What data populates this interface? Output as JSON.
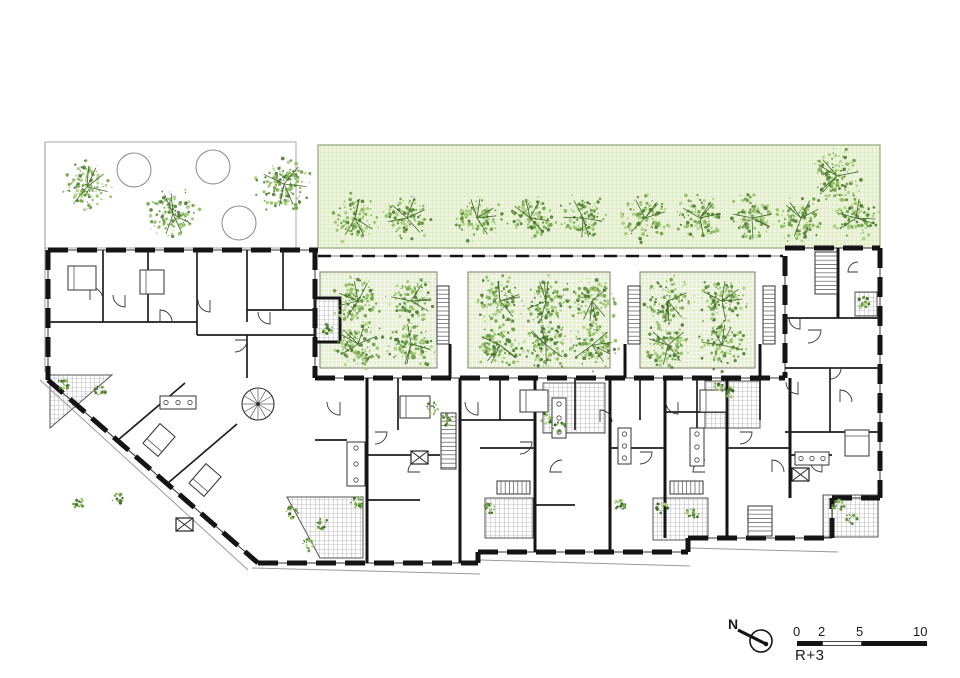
{
  "meta": {
    "level_label": "R+3"
  },
  "compass": {
    "label": "N"
  },
  "scale_bar": {
    "x": 797,
    "y": 641,
    "height": 5,
    "tick_labels": [
      "0",
      "2",
      "5",
      "10"
    ],
    "tick_offsets": [
      -4,
      21,
      59,
      116
    ],
    "segments": [
      {
        "w": 25,
        "filled": true
      },
      {
        "w": 40,
        "filled": false
      },
      {
        "w": 65,
        "filled": true
      }
    ]
  },
  "colors": {
    "wall": "#141414",
    "partition": "#1e1e1e",
    "thin": "#444444",
    "boundary": "#999999",
    "band_bg": "#edf4dd",
    "band_grid": "#d2e3b4",
    "band_border": "#93a878",
    "court_bg": "#e6f0d0",
    "court_grid": "#ffffff",
    "court_border": "#8a8a7a",
    "terrace_line": "#8d8d8d",
    "terrace_border": "#555555",
    "tree_dots": [
      "#4e7c32",
      "#6f9d48",
      "#8fbc63",
      "#a8cd80"
    ],
    "twig": "#44682c",
    "shrub_dark": "#3f662a"
  },
  "plan": {
    "garden": {
      "rect": [
        45,
        142,
        251,
        106
      ],
      "circles": [
        [
          134,
          170,
          17
        ],
        [
          213,
          167,
          17
        ],
        [
          239,
          223,
          17
        ]
      ],
      "trees": [
        [
          87,
          187,
          28
        ],
        [
          173,
          214,
          28
        ],
        [
          284,
          184,
          30
        ]
      ]
    },
    "band": {
      "rect": [
        318,
        145,
        562,
        103
      ],
      "row_y": 218,
      "row_r": 26,
      "row_x": [
        355,
        407,
        477,
        530,
        583,
        645,
        700,
        752,
        801,
        856
      ],
      "extra": [
        837,
        176,
        29
      ]
    },
    "courtyards": {
      "tree_r": 27,
      "items": [
        {
          "rect": [
            320,
            272,
            117,
            96
          ],
          "trees": [
            [
              358,
              301
            ],
            [
              411,
              301
            ],
            [
              358,
              344
            ],
            [
              411,
              344
            ]
          ]
        },
        {
          "rect": [
            468,
            272,
            142,
            96
          ],
          "trees": [
            [
              500,
              301
            ],
            [
              546,
              301
            ],
            [
              592,
              301
            ],
            [
              500,
              345
            ],
            [
              546,
              345
            ],
            [
              592,
              345
            ]
          ]
        },
        {
          "rect": [
            640,
            272,
            115,
            96
          ],
          "trees": [
            [
              668,
              301
            ],
            [
              722,
              301
            ],
            [
              668,
              345
            ],
            [
              722,
              345
            ]
          ]
        }
      ]
    },
    "facades": [
      [
        48,
        250,
        318,
        250
      ],
      [
        48,
        250,
        48,
        380
      ],
      [
        48,
        380,
        258,
        563
      ],
      [
        315,
        250,
        315,
        378
      ],
      [
        315,
        378,
        785,
        378
      ],
      [
        258,
        563,
        478,
        563
      ],
      [
        478,
        552,
        688,
        552
      ],
      [
        688,
        538,
        832,
        538
      ],
      [
        478,
        563,
        478,
        552
      ],
      [
        688,
        552,
        688,
        538
      ],
      [
        832,
        538,
        832,
        498
      ],
      [
        785,
        248,
        880,
        248
      ],
      [
        880,
        248,
        880,
        498
      ],
      [
        832,
        498,
        880,
        498
      ],
      [
        785,
        256,
        785,
        378
      ]
    ],
    "wall2": [
      [
        318,
        256,
        783,
        256
      ]
    ],
    "party": [
      [
        367,
        378,
        367,
        563
      ],
      [
        460,
        378,
        460,
        563
      ],
      [
        535,
        378,
        535,
        552
      ],
      [
        610,
        378,
        610,
        552
      ],
      [
        665,
        378,
        665,
        538
      ],
      [
        727,
        378,
        727,
        538
      ],
      [
        790,
        378,
        790,
        498
      ],
      [
        450,
        344,
        450,
        378
      ],
      [
        625,
        344,
        625,
        378
      ],
      [
        760,
        344,
        760,
        378
      ],
      [
        838,
        248,
        838,
        318
      ]
    ],
    "partitions": [
      [
        103,
        250,
        103,
        322
      ],
      [
        148,
        250,
        148,
        322
      ],
      [
        197,
        250,
        197,
        335
      ],
      [
        247,
        250,
        247,
        322
      ],
      [
        283,
        250,
        283,
        310
      ],
      [
        48,
        322,
        197,
        322
      ],
      [
        197,
        335,
        315,
        335
      ],
      [
        247,
        310,
        315,
        310
      ],
      [
        247,
        335,
        247,
        378
      ],
      [
        118,
        440,
        185,
        383
      ],
      [
        168,
        483,
        237,
        424
      ],
      [
        368,
        455,
        440,
        455
      ],
      [
        480,
        448,
        535,
        448
      ],
      [
        610,
        448,
        665,
        448
      ],
      [
        727,
        448,
        790,
        448
      ],
      [
        460,
        420,
        535,
        420
      ],
      [
        665,
        412,
        727,
        412
      ],
      [
        790,
        455,
        832,
        455
      ],
      [
        785,
        318,
        880,
        318
      ],
      [
        785,
        368,
        880,
        368
      ],
      [
        785,
        432,
        880,
        432
      ],
      [
        830,
        368,
        830,
        432
      ],
      [
        398,
        378,
        398,
        430
      ],
      [
        500,
        378,
        500,
        420
      ],
      [
        575,
        378,
        575,
        430
      ],
      [
        640,
        378,
        640,
        420
      ],
      [
        697,
        378,
        697,
        430
      ],
      [
        760,
        378,
        760,
        420
      ],
      [
        315,
        440,
        347,
        440
      ],
      [
        367,
        500,
        420,
        500
      ],
      [
        535,
        505,
        575,
        505
      ]
    ],
    "terraces": [
      {
        "poly": [
          [
            50,
            375
          ],
          [
            112,
            375
          ],
          [
            50,
            428
          ]
        ]
      },
      {
        "poly": [
          [
            287,
            497
          ],
          [
            363,
            497
          ],
          [
            363,
            558
          ],
          [
            320,
            558
          ]
        ]
      },
      {
        "poly": [
          [
            543,
            383
          ],
          [
            605,
            383
          ],
          [
            605,
            433
          ],
          [
            543,
            433
          ]
        ]
      },
      {
        "poly": [
          [
            705,
            381
          ],
          [
            760,
            381
          ],
          [
            760,
            428
          ],
          [
            705,
            428
          ]
        ]
      },
      {
        "poly": [
          [
            485,
            498
          ],
          [
            533,
            498
          ],
          [
            533,
            538
          ],
          [
            485,
            538
          ]
        ]
      },
      {
        "poly": [
          [
            653,
            498
          ],
          [
            708,
            498
          ],
          [
            708,
            540
          ],
          [
            653,
            540
          ]
        ]
      },
      {
        "poly": [
          [
            823,
            495
          ],
          [
            878,
            495
          ],
          [
            878,
            537
          ],
          [
            823,
            537
          ]
        ]
      },
      {
        "poly": [
          [
            315,
            298
          ],
          [
            340,
            298
          ],
          [
            340,
            342
          ],
          [
            315,
            342
          ]
        ],
        "thick": true
      },
      {
        "poly": [
          [
            855,
            292
          ],
          [
            877,
            292
          ],
          [
            877,
            316
          ],
          [
            855,
            316
          ]
        ]
      }
    ],
    "stairs": [
      [
        441,
        413,
        15,
        56,
        "v"
      ],
      [
        815,
        252,
        22,
        42,
        "v"
      ],
      [
        497,
        481,
        33,
        13,
        "h"
      ],
      [
        670,
        481,
        33,
        13,
        "h"
      ],
      [
        748,
        506,
        24,
        30,
        "v"
      ],
      [
        437,
        286,
        12,
        58,
        "v"
      ],
      [
        628,
        286,
        12,
        58,
        "v"
      ],
      [
        763,
        286,
        12,
        58,
        "v"
      ]
    ],
    "spiral": [
      258,
      404,
      16
    ],
    "shafts": [
      [
        176,
        518
      ],
      [
        411,
        451
      ],
      [
        748,
        508
      ],
      [
        792,
        468
      ]
    ],
    "beds": [
      [
        68,
        266,
        28,
        24,
        0
      ],
      [
        140,
        270,
        24,
        24,
        0
      ],
      [
        400,
        396,
        30,
        22,
        0
      ],
      [
        520,
        390,
        28,
        22,
        0
      ],
      [
        700,
        390,
        26,
        22,
        0
      ],
      [
        146,
        430,
        26,
        20,
        -49
      ],
      [
        192,
        470,
        26,
        20,
        -49
      ],
      [
        845,
        430,
        24,
        26,
        0
      ]
    ],
    "kitchens": [
      [
        160,
        396,
        36,
        13
      ],
      [
        347,
        442,
        18,
        44
      ],
      [
        552,
        398,
        14,
        40
      ],
      [
        690,
        428,
        14,
        38
      ],
      [
        795,
        452,
        34,
        13
      ],
      [
        618,
        428,
        13,
        36
      ]
    ],
    "arcs": [
      [
        90,
        300,
        13,
        3
      ],
      [
        125,
        295,
        12,
        1
      ],
      [
        160,
        322,
        12,
        3
      ],
      [
        210,
        300,
        12,
        1
      ],
      [
        235,
        340,
        12,
        0
      ],
      [
        270,
        312,
        12,
        1
      ],
      [
        340,
        402,
        13,
        1
      ],
      [
        375,
        432,
        12,
        0
      ],
      [
        420,
        472,
        12,
        2
      ],
      [
        478,
        402,
        13,
        1
      ],
      [
        520,
        442,
        12,
        0
      ],
      [
        562,
        472,
        12,
        2
      ],
      [
        600,
        422,
        12,
        3
      ],
      [
        640,
        452,
        12,
        0
      ],
      [
        678,
        402,
        12,
        1
      ],
      [
        705,
        472,
        12,
        2
      ],
      [
        740,
        432,
        12,
        0
      ],
      [
        772,
        472,
        12,
        3
      ],
      [
        798,
        382,
        12,
        1
      ],
      [
        808,
        330,
        13,
        0
      ],
      [
        840,
        402,
        12,
        3
      ],
      [
        822,
        460,
        12,
        1
      ],
      [
        858,
        272,
        10,
        2
      ],
      [
        800,
        318,
        11,
        1
      ],
      [
        830,
        368,
        11,
        0
      ]
    ],
    "shrubs": [
      [
        64,
        384
      ],
      [
        100,
        390
      ],
      [
        78,
        504
      ],
      [
        117,
        499
      ],
      [
        292,
        512
      ],
      [
        308,
        545
      ],
      [
        322,
        524
      ],
      [
        357,
        503
      ],
      [
        433,
        408
      ],
      [
        447,
        420
      ],
      [
        547,
        418
      ],
      [
        559,
        427
      ],
      [
        490,
        507
      ],
      [
        620,
        505
      ],
      [
        662,
        508
      ],
      [
        693,
        513
      ],
      [
        717,
        388
      ],
      [
        730,
        392
      ],
      [
        838,
        505
      ],
      [
        852,
        518
      ],
      [
        327,
        330
      ],
      [
        864,
        303
      ]
    ],
    "boundary": [
      [
        45,
        142,
        45,
        372
      ],
      [
        40,
        380,
        248,
        570
      ],
      [
        252,
        568,
        480,
        574
      ],
      [
        480,
        560,
        690,
        566
      ],
      [
        690,
        548,
        838,
        552
      ]
    ]
  }
}
